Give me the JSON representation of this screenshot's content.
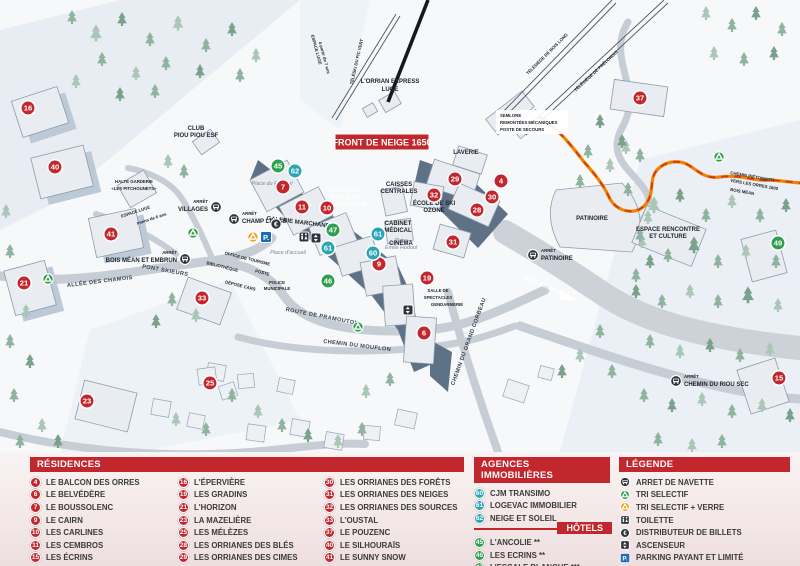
{
  "colors": {
    "residence": "#c1272d",
    "agence": "#2aa5b5",
    "hotel": "#2f9e4e",
    "accent_red": "#c1272d",
    "parking_blue": "#1c6ab8",
    "glass_orange": "#f0a01e",
    "path_orange": "#f08300"
  },
  "icons": {
    "euro_glyph": "€",
    "parking_glyph": "P."
  },
  "map": {
    "banner": "FRONT DE NEIGE 1650",
    "labels": {
      "arret": "ARRÊT",
      "espace_luge_7ans_1": "ESPACE LUGE",
      "espace_luge_7ans_2": "à partir de 7 ans",
      "teleski_pic_vert": "TÉLÉSKI DU PIC VERT",
      "orrian_express_1": "L'ORRIAN EXPRESS",
      "orrian_express_2": "LUGE",
      "telesiege_bois_long": "TÉLÉSIÈGE DE BOIS LONG",
      "telesiege_prelongis": "TÉLÉSIÈGE DE PRÉLONGIS",
      "semlore_1": "SEMLORE",
      "semlore_2": "REMONTÉES MÉCANIQUES",
      "semlore_3": "POSTE DE SECOURS",
      "club_piou_1": "CLUB",
      "club_piou_2": "PIOU PIOU ESF",
      "halte_garderie_1": "HALTE GARDERIE",
      "halte_garderie_2": "«LES PITCHOUNETS»",
      "espace_luge_6ans_1": "ESPACE LUGE",
      "espace_luge_6ans_2": "moins de 6 ans",
      "villages": "VILLAGES",
      "champ_lacas": "CHAMP LACAS",
      "place_festival": "Place du Festival",
      "la_bulle_1": "LA BULLE",
      "la_bulle_2": "ÉCOLE DU",
      "la_bulle_3": "SKI FRANÇAIS",
      "galerie_marchande": "GALERIE MARCHANDE",
      "caisses_1": "CAISSES",
      "caisses_2": "CENTRALES",
      "laverie": "LAVERIE",
      "ecole_ozone_1": "ÉCOLE DE SKI",
      "ecole_ozone_2": "OZONE",
      "cabinet_1": "CABINET",
      "cabinet_2": "MÉDICAL",
      "cinema": "CINÉMA",
      "bois_mean_embrun": "BOIS MÉAN ET EMBRUN",
      "allee_chamois": "ALLÉE DES CHAMOIS",
      "pont_skieurs": "PONT SKIEURS",
      "office_tourisme": "OFFICE DE TOURISME",
      "bibliotheque": "BIBLIOTHÈQUE",
      "poste": "POSTE",
      "police_1": "POLICE",
      "police_2": "MUNICIPALE",
      "depose_cars": "DÉPOSE CARS",
      "place_accueil": "Place d'accueil",
      "route_pramouton": "ROUTE DE PRAMOUTON",
      "chemin_mouflon": "CHEMIN DU MOUFLON",
      "chemin_grand_corbeau": "CHEMIN DU GRAND CORBEAU",
      "vers_embrun": "VERS EMBRUN",
      "patinoire": "PATINOIRE",
      "espace_rencontre_1": "ESPACE RENCONTRE",
      "espace_rencontre_2": "ET CULTURE",
      "chemin_pietonnier_1": "CHEMIN PIÉTONNIER",
      "chemin_pietonnier_2": "VERS LES ORRES 1800",
      "chemin_pietonnier_3": "BOIS MÉAN",
      "chemin_riou_sec": "CHEMIN DU RIOU SEC",
      "salle_1": "SALLE DE",
      "salle_2": "SPECTACLES",
      "gendarmerie": "GENDARMERIE",
      "place_hodoul_1": "Place",
      "place_hodoul_2": "Émile Hodoul"
    },
    "markers": {
      "m4": "4",
      "m6": "6",
      "m7": "7",
      "m9": "9",
      "m10": "10",
      "m11": "11",
      "m15": "15",
      "m16": "16",
      "m19": "19",
      "m21": "21",
      "m23": "23",
      "m25": "25",
      "m28": "28",
      "m29": "29",
      "m30": "30",
      "m31": "31",
      "m32": "32",
      "m33": "33",
      "m37": "37",
      "m40": "40",
      "m41": "41",
      "m45": "45",
      "m46": "46",
      "m47": "47",
      "m49": "49",
      "m60": "60",
      "m61": "61",
      "m62": "62"
    }
  },
  "legend": {
    "residences": {
      "title": "RÉSIDENCES",
      "columns": [
        [
          {
            "n": "4",
            "label": "LE BALCON DES ORRES"
          },
          {
            "n": "6",
            "label": "LE BELVÉDÈRE"
          },
          {
            "n": "7",
            "label": "LE BOUSSOLENC"
          },
          {
            "n": "9",
            "label": "LE CAIRN"
          },
          {
            "n": "10",
            "label": "LES CARLINES"
          },
          {
            "n": "11",
            "label": "LES CEMBROS"
          },
          {
            "n": "15",
            "label": "LES ÉCRINS"
          }
        ],
        [
          {
            "n": "16",
            "label": "L'ÉPERVIÈRE"
          },
          {
            "n": "19",
            "label": "LES GRADINS"
          },
          {
            "n": "21",
            "label": "L'HORIZON"
          },
          {
            "n": "23",
            "label": "LA MAZELIÈRE"
          },
          {
            "n": "25",
            "label": "LES MÉLÈZES"
          },
          {
            "n": "28",
            "label": "LES ORRIANES DES BLÉS"
          },
          {
            "n": "29",
            "label": "LES ORRIANES DES CIMES"
          }
        ],
        [
          {
            "n": "30",
            "label": "LES ORRIANES DES FORÊTS"
          },
          {
            "n": "31",
            "label": "LES ORRIANES DES NEIGES"
          },
          {
            "n": "32",
            "label": "LES ORRIANES DES SOURCES"
          },
          {
            "n": "33",
            "label": "L'OUSTAL"
          },
          {
            "n": "37",
            "label": "LE POUZENC"
          },
          {
            "n": "40",
            "label": "LE SILHOURAÏS"
          },
          {
            "n": "41",
            "label": "LE SUNNY SNOW"
          }
        ]
      ]
    },
    "agences": {
      "title": "AGENCES IMMOBILIÈRES",
      "items": [
        {
          "n": "60",
          "label": "CJM TRANSIMO"
        },
        {
          "n": "61",
          "label": "LOGEVAC IMMOBILIER"
        },
        {
          "n": "62",
          "label": "NEIGE ET SOLEIL"
        }
      ]
    },
    "hotels": {
      "title": "HÔTELS",
      "items": [
        {
          "n": "45",
          "label": "L'ANCOLIE **"
        },
        {
          "n": "46",
          "label": "LES ECRINS **"
        },
        {
          "n": "47",
          "label": "L'ESCALE BLANCHE ***"
        },
        {
          "n": "49",
          "label": "LES TRAPPEURS **"
        }
      ]
    },
    "legende": {
      "title": "LÉGENDE",
      "items": [
        {
          "icon": "bus-icon",
          "label": "ARRET DE NAVETTE"
        },
        {
          "icon": "recycle-green-icon",
          "label": "TRI SELECTIF"
        },
        {
          "icon": "recycle-glass-icon",
          "label": "TRI SELECTIF + VERRE"
        },
        {
          "icon": "toilet-icon",
          "label": "TOILETTE"
        },
        {
          "icon": "atm-icon",
          "label": "DISTRIBUTEUR DE BILLETS"
        },
        {
          "icon": "elevator-icon",
          "label": "ASCENSEUR"
        },
        {
          "icon": "parking-icon",
          "label": "PARKING PAYANT ET LIMITÉ"
        }
      ]
    }
  }
}
